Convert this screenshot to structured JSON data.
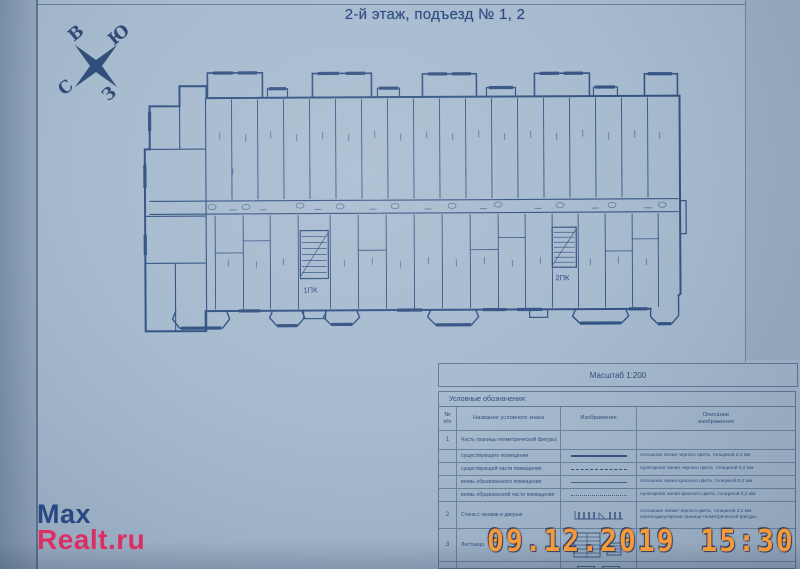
{
  "title": "2-й этаж, подъезд № 1, 2",
  "compass": {
    "top_left": "В",
    "top_right": "Ю",
    "bottom_left": "С",
    "bottom_right": "З"
  },
  "plan": {
    "stair1_label": "1ПК",
    "stair2_label": "2ПК"
  },
  "legend": {
    "scale": "Масштаб 1:200",
    "caption": "Условные обозначения:",
    "headers": {
      "num": "№\nп/п",
      "name": "Название условного знака",
      "image": "Изображение",
      "description": "Описание\nизображения"
    },
    "rows": [
      {
        "num": "1",
        "name": "Часть границы геометрической фигуры:",
        "desc": ""
      },
      {
        "num": "",
        "name": "существующего помещения",
        "desc": "сплошная линия черного цвета, толщиной 0,4 мм"
      },
      {
        "num": "",
        "name": "существующей части помещения",
        "desc": "пунктирная линия черного цвета, толщиной 0,2 мм"
      },
      {
        "num": "",
        "name": "вновь образованного помещения",
        "desc": "сплошная линия красного цвета, толщиной 0,2 мм"
      },
      {
        "num": "",
        "name": "вновь образованной части помещения",
        "desc": "пунктирная линия красного цвета, толщиной 0,2 мм"
      },
      {
        "num": "2",
        "name": "Стена с окнами и дверью",
        "desc": "сплошные линии черного цвета, толщиной 3,2 мм , перпендикулярные границе геометрической фигуры"
      },
      {
        "num": "3",
        "name": "Лестница",
        "desc": ""
      },
      {
        "num": "4",
        "name": "",
        "desc": ""
      }
    ]
  },
  "watermark": {
    "line1": "Max",
    "line2": "Realt.ru",
    "color_line1": "#1e3e7e",
    "color_line2": "#e0275f"
  },
  "timestamp": {
    "text": "09.12.2019 15:30",
    "color": "#f49a3a"
  },
  "colors": {
    "paper": "#a7bbcf",
    "ink": "#2b4b7e"
  }
}
